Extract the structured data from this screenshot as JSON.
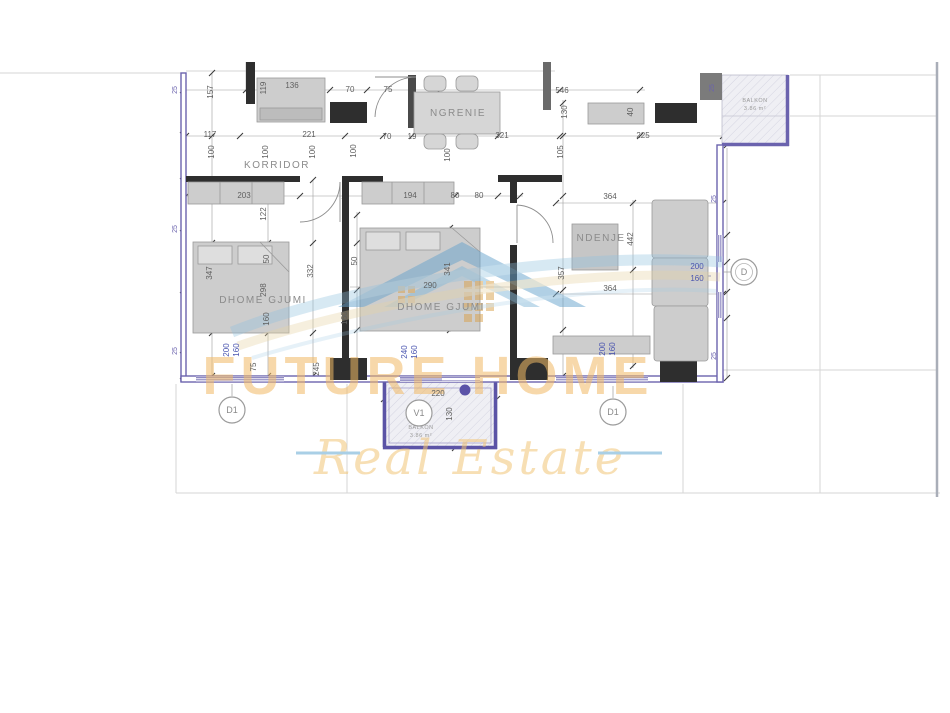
{
  "plan": {
    "title": "apartment-floor-plan",
    "rooms": [
      {
        "name": "KORRIDOR",
        "x": 277,
        "y": 168,
        "fs": 9
      },
      {
        "name": "NGRENIE",
        "x": 458,
        "y": 116,
        "fs": 9
      },
      {
        "name": "DHOME GJUMI",
        "x": 263,
        "y": 303,
        "fs": 10
      },
      {
        "name": "DHOME GJUMI",
        "x": 441,
        "y": 310,
        "fs": 10
      },
      {
        "name": "NDENJE",
        "x": 601,
        "y": 241,
        "fs": 10
      }
    ],
    "balconies": [
      {
        "name": "BALKON",
        "area": "3.86 m²",
        "x": 755,
        "y": 102
      },
      {
        "name": "BALKON",
        "area": "3.86 m²",
        "x": 421,
        "y": 429
      }
    ],
    "markers": [
      {
        "label": "D1",
        "x": 232,
        "y": 410,
        "leader": [
          232,
          396,
          232,
          384
        ]
      },
      {
        "label": "D1",
        "x": 613,
        "y": 412,
        "leader": [
          613,
          398,
          613,
          386
        ]
      },
      {
        "label": "V1",
        "x": 419,
        "y": 413,
        "leader": null
      },
      {
        "label": "D",
        "x": 744,
        "y": 272,
        "leader": [
          723,
          272,
          731,
          272
        ]
      }
    ],
    "dimensions": [
      {
        "t": "157",
        "x": 213,
        "y": 92,
        "r": 1
      },
      {
        "t": "119",
        "x": 266,
        "y": 88,
        "r": 1
      },
      {
        "t": "136",
        "x": 292,
        "y": 88
      },
      {
        "t": "70",
        "x": 350,
        "y": 92
      },
      {
        "t": "75",
        "x": 388,
        "y": 92
      },
      {
        "t": "546",
        "x": 562,
        "y": 93
      },
      {
        "t": "130",
        "x": 567,
        "y": 112,
        "r": 1
      },
      {
        "t": "40",
        "x": 633,
        "y": 112,
        "r": 1
      },
      {
        "t": "117",
        "x": 210,
        "y": 137
      },
      {
        "t": "221",
        "x": 309,
        "y": 137
      },
      {
        "t": "70",
        "x": 387,
        "y": 139
      },
      {
        "t": "19",
        "x": 412,
        "y": 139
      },
      {
        "t": "321",
        "x": 502,
        "y": 138
      },
      {
        "t": "225",
        "x": 643,
        "y": 138
      },
      {
        "t": "100",
        "x": 214,
        "y": 152,
        "r": 1
      },
      {
        "t": "100",
        "x": 268,
        "y": 152,
        "r": 1
      },
      {
        "t": "100",
        "x": 315,
        "y": 152,
        "r": 1
      },
      {
        "t": "100",
        "x": 356,
        "y": 151,
        "r": 1
      },
      {
        "t": "100",
        "x": 450,
        "y": 155,
        "r": 1
      },
      {
        "t": "105",
        "x": 563,
        "y": 152,
        "r": 1
      },
      {
        "t": "203",
        "x": 244,
        "y": 198
      },
      {
        "t": "194",
        "x": 410,
        "y": 198
      },
      {
        "t": "80",
        "x": 455,
        "y": 198
      },
      {
        "t": "80",
        "x": 479,
        "y": 198
      },
      {
        "t": "122",
        "x": 266,
        "y": 214,
        "r": 1
      },
      {
        "t": "347",
        "x": 212,
        "y": 273,
        "r": 1
      },
      {
        "t": "50",
        "x": 269,
        "y": 259,
        "r": 1
      },
      {
        "t": "298",
        "x": 266,
        "y": 290,
        "r": 1
      },
      {
        "t": "160",
        "x": 269,
        "y": 319,
        "r": 1
      },
      {
        "t": "332",
        "x": 313,
        "y": 271,
        "r": 1
      },
      {
        "t": "50",
        "x": 357,
        "y": 261,
        "r": 1
      },
      {
        "t": "341",
        "x": 450,
        "y": 269,
        "r": 1
      },
      {
        "t": "290",
        "x": 430,
        "y": 288
      },
      {
        "t": "160",
        "x": 347,
        "y": 318,
        "r": 1
      },
      {
        "t": "364",
        "x": 610,
        "y": 199
      },
      {
        "t": "442",
        "x": 633,
        "y": 239,
        "r": 1
      },
      {
        "t": "357",
        "x": 564,
        "y": 273,
        "r": 1
      },
      {
        "t": "364",
        "x": 610,
        "y": 291
      },
      {
        "t": "200",
        "x": 697,
        "y": 269,
        "c": "b"
      },
      {
        "t": "160",
        "x": 697,
        "y": 281,
        "c": "b"
      },
      {
        "t": "200",
        "x": 229,
        "y": 350,
        "r": 1,
        "c": "b"
      },
      {
        "t": "160",
        "x": 239,
        "y": 350,
        "r": 1,
        "c": "b"
      },
      {
        "t": "240",
        "x": 407,
        "y": 352,
        "r": 1,
        "c": "b"
      },
      {
        "t": "160",
        "x": 417,
        "y": 352,
        "r": 1,
        "c": "b"
      },
      {
        "t": "200",
        "x": 605,
        "y": 349,
        "r": 1,
        "c": "b"
      },
      {
        "t": "160",
        "x": 615,
        "y": 349,
        "r": 1,
        "c": "b"
      },
      {
        "t": "75",
        "x": 256,
        "y": 367,
        "r": 1
      },
      {
        "t": "245",
        "x": 319,
        "y": 369,
        "r": 1
      },
      {
        "t": "220",
        "x": 438,
        "y": 396
      },
      {
        "t": "130",
        "x": 452,
        "y": 414,
        "r": 1
      },
      {
        "t": "25",
        "x": 177,
        "y": 90,
        "r": 1,
        "c": "p"
      },
      {
        "t": "25",
        "x": 177,
        "y": 229,
        "r": 1,
        "c": "p"
      },
      {
        "t": "25",
        "x": 177,
        "y": 351,
        "r": 1,
        "c": "p"
      },
      {
        "t": "25",
        "x": 714,
        "y": 88,
        "r": 1,
        "c": "p"
      },
      {
        "t": "25",
        "x": 716,
        "y": 199,
        "r": 1,
        "c": "p"
      },
      {
        "t": "25",
        "x": 716,
        "y": 356,
        "r": 1,
        "c": "p"
      }
    ]
  },
  "watermark": {
    "line1": "FUTURE HOME",
    "line2": "Real Estate",
    "gold": "#f2ba66",
    "gold2": "#f2c577",
    "blue": "#7fb0d4",
    "beige": "#e6d2a2"
  },
  "colors": {
    "wall_purple": "#6b63ae",
    "wall_black": "#2e2e2e",
    "furniture": "#cdcdcd",
    "dim_text": "#5f5f5f",
    "window_blue": "#4a55b0"
  }
}
